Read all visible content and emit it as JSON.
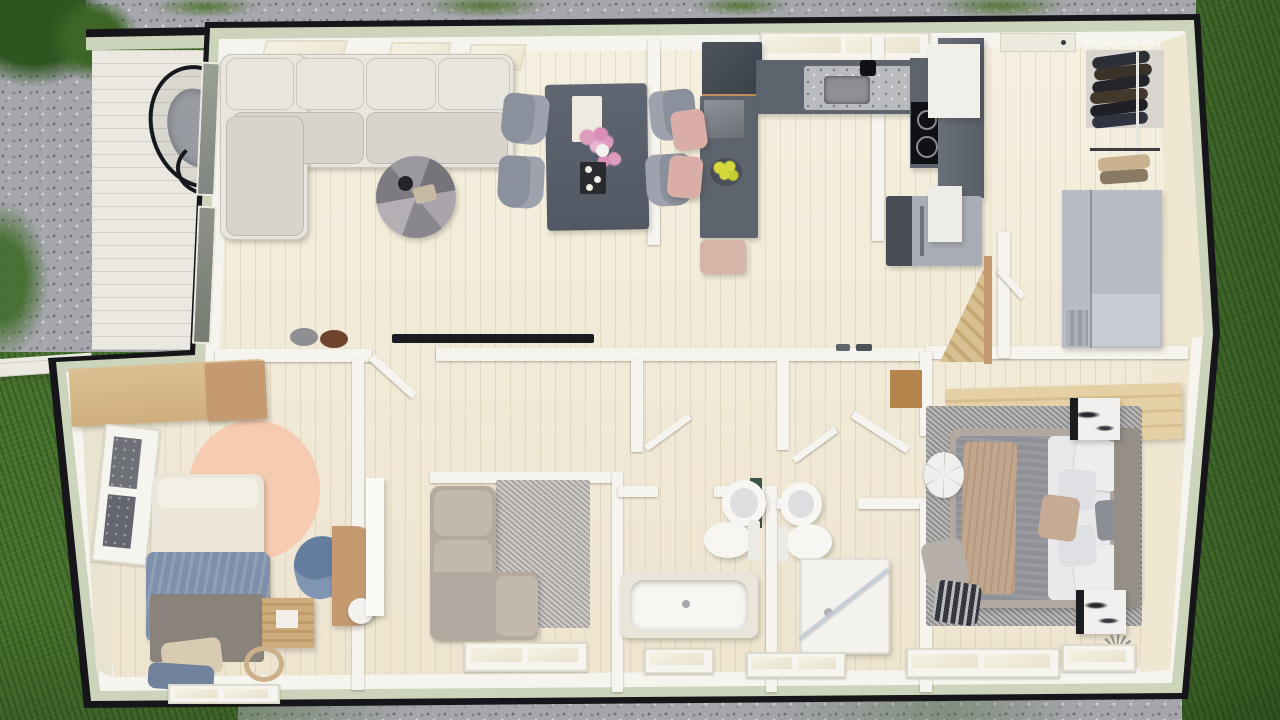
{
  "scene": {
    "title": "3D floor plan render — single-storey cabin, top-down view",
    "description": "Photorealistic top-down 3D rendering of a single-storey house floor plan surrounded by lawn and gravel: open-plan living and dining room, U-shaped kitchen, entry hall with open wardrobe, kids bedroom, TV lounge, two bathrooms and a master bedroom. A side porch with a hanging egg chair sits on the west side.",
    "width_px": 1280,
    "height_px": 720
  },
  "colors": {
    "grass": "#47702e",
    "grassDark": "#2e5420",
    "gravel": "#a6a6ad",
    "deck": "#eae8e0",
    "roofEdge": "#16161a",
    "siding": "#ccd5bb",
    "wall": "#f6f4ee",
    "floor": "#f3ecd9",
    "innerWood": "#efe7d2",
    "sofaCream": "#e9e5df",
    "sofaCreamShade": "#d8d3cb",
    "sofaTaupe": "#b4a9a0",
    "sofaSeatTaupe": "#c2b8ae",
    "counter": "#5d646e",
    "cooktop": "#101114",
    "granite": "#babbbf",
    "fridgeLight": "#a8adb6",
    "fridgeDark": "#474c55",
    "stoolPink": "#d8aea6",
    "chairGray": "#8b919c",
    "tableDark": "#596068",
    "woodLight": "#dcbf92",
    "woodMid": "#c59a71",
    "woodDark": "#b5854e",
    "rugPeach": "#f5cbb1",
    "rugGray": "#9d9c9a",
    "rugDen": "#b9b5b1",
    "bedWhite": "#ece6da",
    "bedBlue": "#7e91aa",
    "bedBase": "#8a837b",
    "blanketGray": "#8f9196",
    "duvetWhite": "#e9e9ec",
    "throwTan": "#c2a68e",
    "headboard": "#958f88",
    "bedFrame": "#b2a89f",
    "marble": "#f1f0ee",
    "marbleDark": "#1b1c20",
    "clothesDark": "#2c2f36",
    "clothesTan": "#c9b08e",
    "shelfGray": "#b9bcc2",
    "basinWhite": "#f7f6f3",
    "glass": "#9aa095",
    "pouf": "#efefed",
    "lampWhite": "#f4f2ee",
    "tv": "#1b1c21",
    "figurineGray": "#8e8f93",
    "teddyBrown": "#6e452c",
    "fruitYellow": "#d6d93b",
    "flowerPink": "#dd9cbd",
    "vanityGreen": "#3c554b",
    "eggFrame": "#17181c",
    "eggCushion": "#989ba1"
  },
  "exterior": {
    "areas": [
      "lawn",
      "gravel-yard",
      "side-porch-deck",
      "roof-edge-shadow",
      "sage-green-siding"
    ],
    "porch_furniture": [
      "hanging-egg-chair"
    ]
  },
  "rooms": [
    {
      "id": "living-room",
      "name": "Living room",
      "furniture": [
        "corner-sofa-cream",
        "round-coffee-table",
        "dining-table",
        "dining-chairs-x4",
        "flower-vase",
        "candle-tray",
        "wall-tv",
        "elephant-figurine",
        "teddy-bear"
      ]
    },
    {
      "id": "kitchen",
      "name": "Kitchen",
      "furniture": [
        "u-shaped-counter",
        "granite-sink",
        "faucet",
        "induction-cooktop",
        "coffee-station",
        "kitchen-island",
        "bar-stools-pink-x2",
        "bench-pink",
        "fruit-bowl",
        "tall-cabinet",
        "fridge"
      ]
    },
    {
      "id": "entry-hall",
      "name": "Entry hall",
      "furniture": [
        "white-cabinet",
        "white-sideboard",
        "open-wardrobe",
        "hanging-jackets",
        "clothes-rail",
        "folded-clothes",
        "gray-shelving-unit",
        "loft-ladder",
        "shoes"
      ]
    },
    {
      "id": "hallway",
      "name": "Hallway",
      "furniture": [
        "open-door-kids",
        "open-door-bath-1",
        "open-door-bath-2",
        "open-door-master",
        "open-door-entry"
      ]
    },
    {
      "id": "kids-bedroom",
      "name": "Kids bedroom",
      "furniture": [
        "wooden-desk",
        "desk-cabinet",
        "single-bed",
        "blue-blanket",
        "floor-pillows",
        "crate-nightstand",
        "desk-chair-blue",
        "side-table",
        "ball-lamp",
        "round-peach-rug",
        "west-window"
      ]
    },
    {
      "id": "tv-lounge",
      "name": "TV lounge",
      "furniture": [
        "corner-sofa-taupe",
        "gray-rug",
        "sliding-door",
        "south-window"
      ]
    },
    {
      "id": "bathroom-1",
      "name": "Bathroom with bathtub",
      "furniture": [
        "bathtub",
        "toilet",
        "round-basin",
        "vanity-panel",
        "south-window"
      ]
    },
    {
      "id": "bathroom-2",
      "name": "Shower room",
      "furniture": [
        "corner-shower",
        "glass-screen",
        "toilet",
        "round-basin",
        "south-window"
      ]
    },
    {
      "id": "master-bedroom",
      "name": "Master bedroom",
      "furniture": [
        "double-bed",
        "gray-blanket",
        "white-duvet",
        "tan-throw",
        "pillows",
        "headboard",
        "marble-nightstand-x2",
        "storage-bench-wood",
        "flower-pouf",
        "floor-cushions",
        "striped-pillow",
        "gray-rug",
        "south-window"
      ]
    }
  ]
}
